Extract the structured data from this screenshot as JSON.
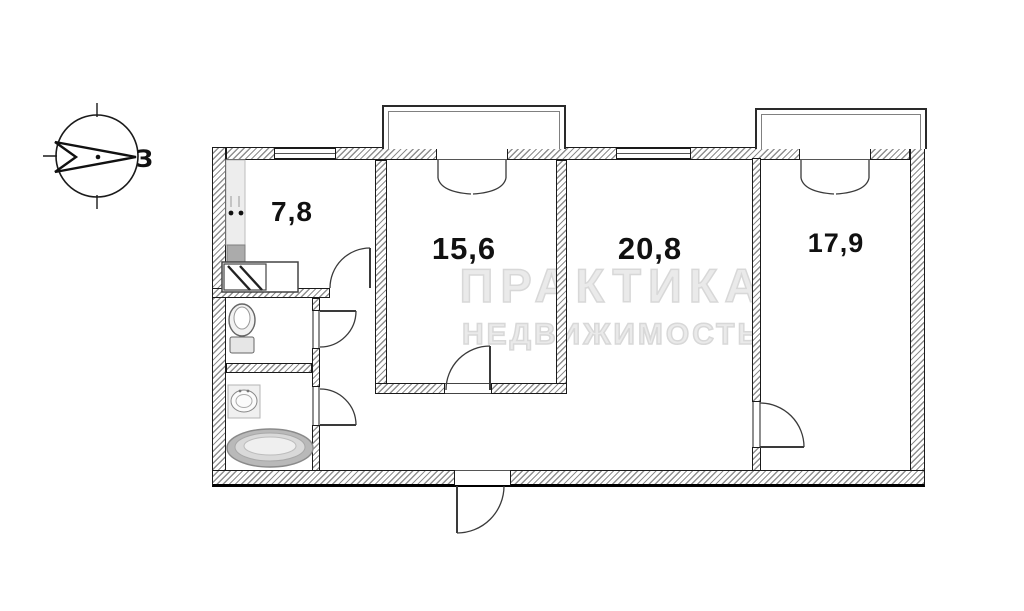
{
  "rooms": [
    {
      "name": "kitchen",
      "area": "7,8"
    },
    {
      "name": "room-15-6",
      "area": "15,6"
    },
    {
      "name": "room-20-8",
      "area": "20,8"
    },
    {
      "name": "room-17-9",
      "area": "17,9"
    }
  ],
  "compass": {
    "west_label": "З"
  },
  "watermark": {
    "line1": "ПРАКТИКА",
    "line2": "НЕДВИЖИМОСТЬ"
  },
  "colors": {
    "line": "#1a1a1a",
    "hatch": "#8f8f8f",
    "watermark": "#d8d8d8",
    "label": "#111111"
  }
}
